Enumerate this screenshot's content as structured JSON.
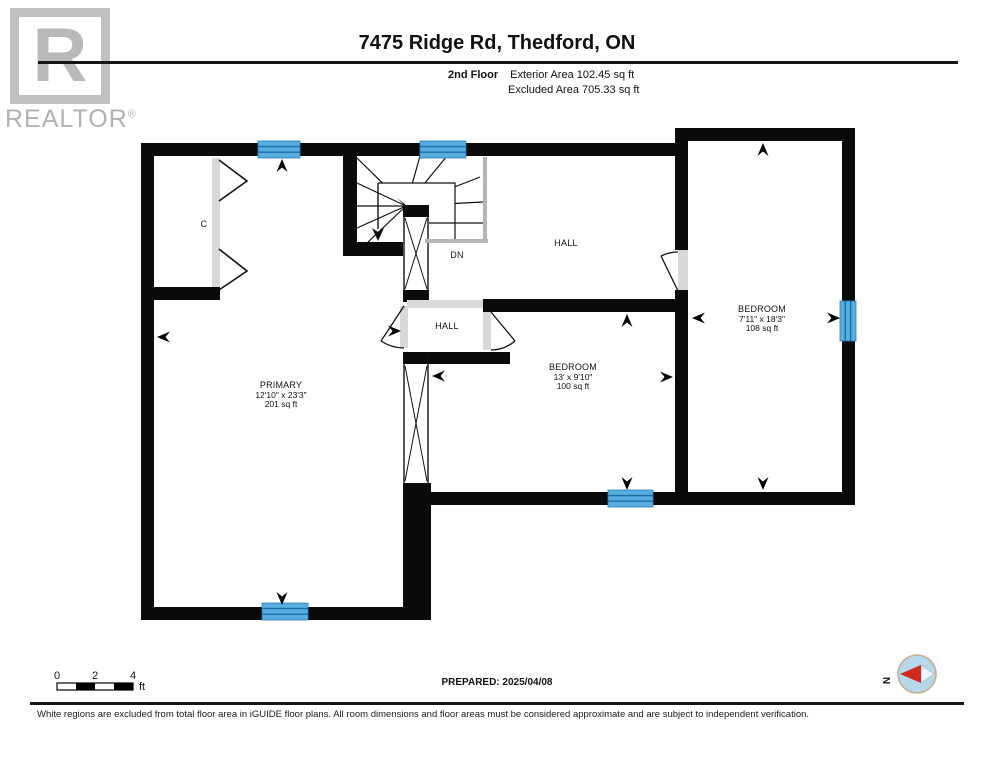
{
  "header": {
    "logo_letter": "R",
    "brand": "REALTOR",
    "reg": "®",
    "title": "7475 Ridge Rd, Thedford, ON",
    "floor_label": "2nd Floor",
    "exterior_area": "Exterior Area 102.45 sq ft",
    "excluded_area": "Excluded Area 705.33 sq ft"
  },
  "rooms": {
    "primary": {
      "name": "PRIMARY",
      "dims": "12'10\" x 23'3\"",
      "area": "201 sq ft"
    },
    "bedroom_mid": {
      "name": "BEDROOM",
      "dims": "13' x 9'10\"",
      "area": "100 sq ft"
    },
    "bedroom_right": {
      "name": "BEDROOM",
      "dims": "7'11\" x 18'3\"",
      "area": "108 sq ft"
    },
    "hall_upper": "HALL",
    "hall_lower": "HALL",
    "closet": "C",
    "stairs_dn": "DN"
  },
  "scale_bar": {
    "t0": "0",
    "t2": "2",
    "t4": "4",
    "unit": "ft"
  },
  "prepared": "PREPARED: 2025/04/08",
  "compass": {
    "n": "N"
  },
  "footer": "White regions are excluded from total floor area in iGUIDE floor plans. All room dimensions and floor areas must be considered approximate and are subject to independent verification.",
  "colors": {
    "wall": "#0a0a0a",
    "window_fill": "#58ade0",
    "window_line": "#1d6fa3",
    "door_gray": "#d8d8d8",
    "rail_gray": "#b5b5b5",
    "logo_gray": "#b9b9b9",
    "compass_blue": "#b5d8ec",
    "compass_red": "#d2281e",
    "compass_ring": "#c7ae8e"
  }
}
